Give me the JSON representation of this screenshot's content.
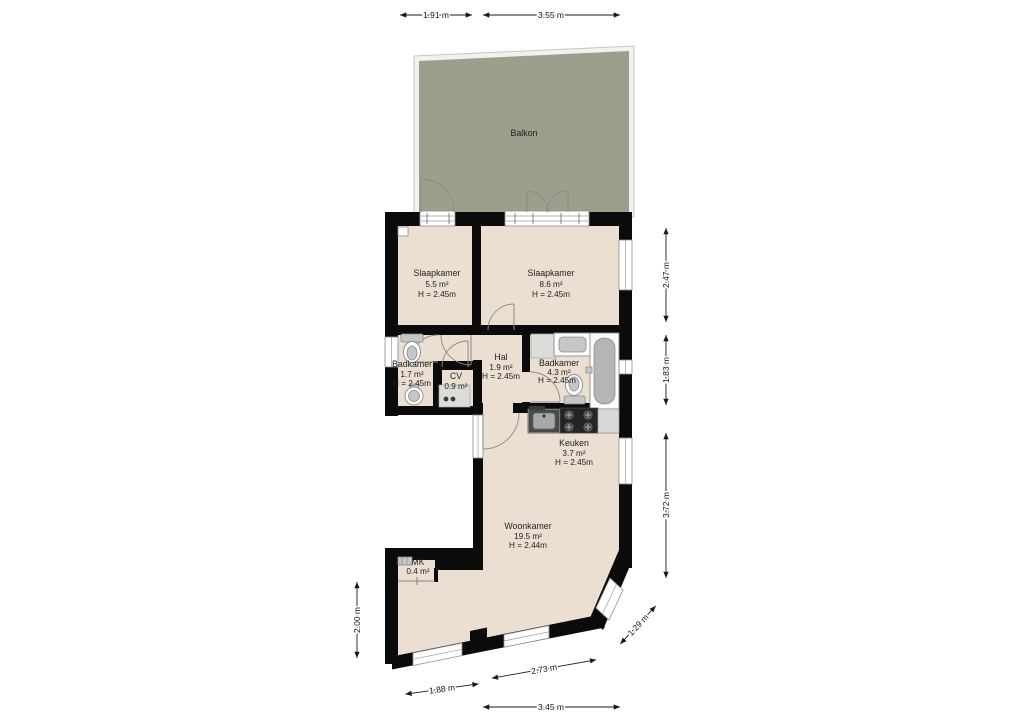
{
  "plan_title": "Floor plan",
  "colors": {
    "wall": "#0b0b0b",
    "floor": "#ebdfd1",
    "balcony": "#9aa08b"
  },
  "rooms": [
    {
      "id": "balkon",
      "name": "Balkon"
    },
    {
      "id": "slaapkamer1",
      "name": "Slaapkamer",
      "area": "5.5 m²",
      "height": "H = 2.45m"
    },
    {
      "id": "slaapkamer2",
      "name": "Slaapkamer",
      "area": "8.6 m²",
      "height": "H = 2.45m"
    },
    {
      "id": "badkamer1",
      "name": "Badkamer",
      "area": "1.7 m²",
      "height": "H = 2.45m"
    },
    {
      "id": "cv",
      "name": "CV",
      "area": "0.9 m²"
    },
    {
      "id": "hal",
      "name": "Hal",
      "area": "1.9 m²",
      "height": "H = 2.45m"
    },
    {
      "id": "badkamer2",
      "name": "Badkamer",
      "area": "4.3 m²",
      "height": "H = 2.45m"
    },
    {
      "id": "keuken",
      "name": "Keuken",
      "area": "3.7 m²",
      "height": "H = 2.45m"
    },
    {
      "id": "woonkamer",
      "name": "Woonkamer",
      "area": "19.5 m²",
      "height": "H = 2.44m"
    },
    {
      "id": "mk",
      "name": "MK",
      "area": "0.4 m²"
    }
  ],
  "dimensions": {
    "top": [
      "1.91 m",
      "3.55 m"
    ],
    "right": [
      "2.47 m",
      "1.83 m",
      "3.72 m"
    ],
    "diagonal": [
      "1.29 m"
    ],
    "bottom": [
      "1.88 m",
      "2.73 m",
      "3.45 m"
    ],
    "left": [
      "2.00 m"
    ]
  }
}
